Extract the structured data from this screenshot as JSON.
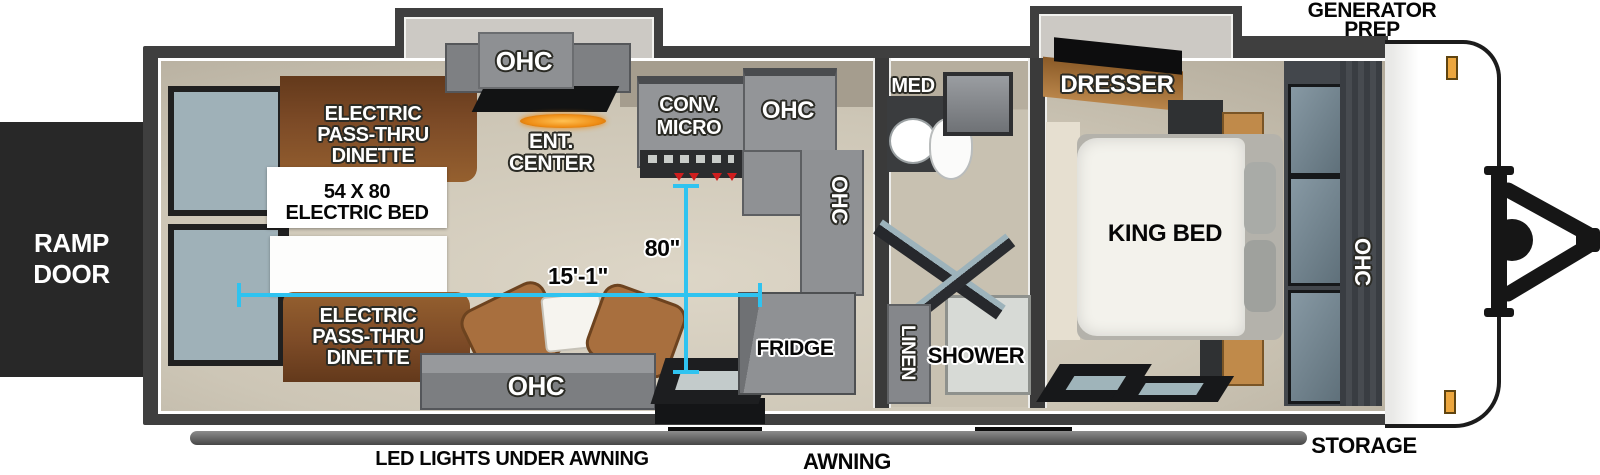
{
  "colors": {
    "measure_accent": "#2fc3f0",
    "wall": "#3f3f3f",
    "floor": "#cdc6b6",
    "dinette_wood": "#7d4b27",
    "cabinet_gray": "#8f9194",
    "warm_wood": "#c08a4a"
  },
  "exterior": {
    "ramp_door": [
      "RAMP",
      "DOOR"
    ],
    "generator_prep": [
      "GENERATOR",
      "PREP"
    ],
    "storage": "STORAGE",
    "awning": "AWNING",
    "led_lights": "LED LIGHTS UNDER AWNING"
  },
  "garage": {
    "dinette_top": [
      "ELECTRIC",
      "PASS-THRU",
      "DINETTE"
    ],
    "dinette_bottom": [
      "ELECTRIC",
      "PASS-THRU",
      "DINETTE"
    ],
    "electric_bed": [
      "54 X 80",
      "ELECTRIC BED"
    ],
    "ent_center": [
      "ENT.",
      "CENTER"
    ],
    "ohc_slide": "OHC",
    "ohc_bottom": "OHC"
  },
  "kitchen": {
    "conv_micro": [
      "CONV.",
      "MICRO"
    ],
    "ohc_upper": "OHC",
    "ohc_corner": "OHC",
    "fridge": "FRIDGE"
  },
  "bathroom": {
    "med": "MED",
    "linen": "LINEN",
    "shower": "SHOWER"
  },
  "bedroom": {
    "dresser": "DRESSER",
    "king_bed": "KING BED",
    "ohc": "OHC"
  },
  "measurements": {
    "interior_width": "80\"",
    "garage_length": "15'-1\""
  }
}
